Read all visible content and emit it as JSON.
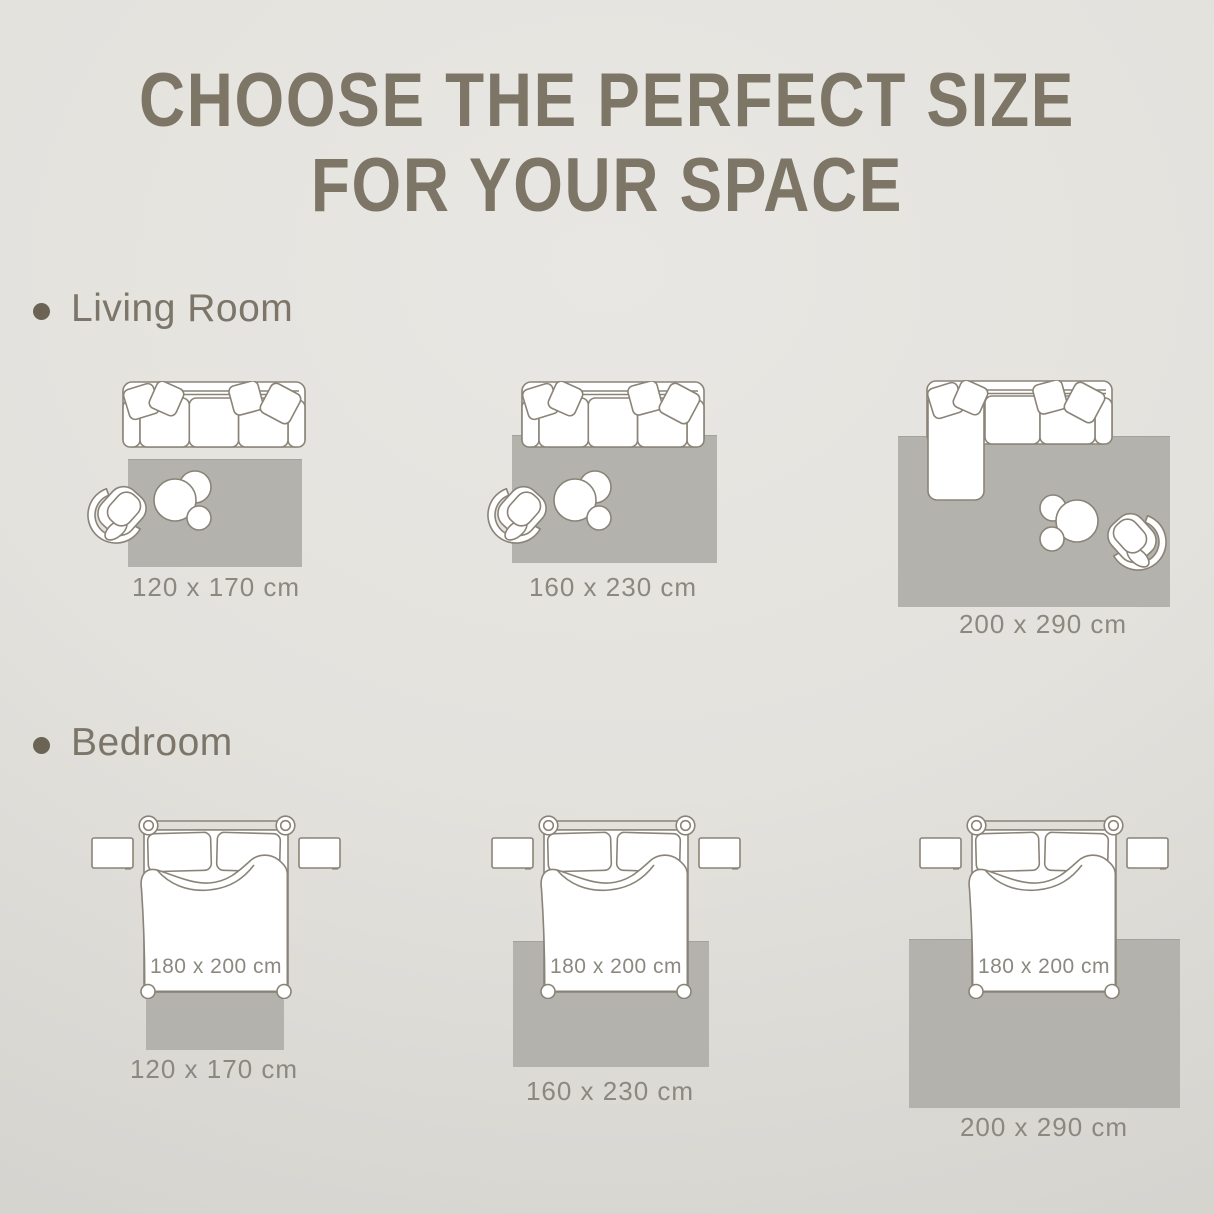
{
  "title": {
    "line1": "CHOOSE THE PERFECT SIZE",
    "line2": "FOR YOUR SPACE"
  },
  "sections": {
    "living_room": {
      "label": "Living Room",
      "items": [
        {
          "rug_size": "120 x 170 cm"
        },
        {
          "rug_size": "160 x 230 cm"
        },
        {
          "rug_size": "200 x 290 cm"
        }
      ]
    },
    "bedroom": {
      "label": "Bedroom",
      "items": [
        {
          "rug_size": "120 x 170 cm",
          "bed_size": "180 x 200 cm"
        },
        {
          "rug_size": "160 x 230 cm",
          "bed_size": "180 x 200 cm"
        },
        {
          "rug_size": "200 x 290 cm",
          "bed_size": "180 x 200 cm"
        }
      ]
    }
  },
  "colors": {
    "title_text": "#7d7566",
    "heading_text": "#7c7569",
    "bullet": "#6b6455",
    "label_text": "#8b887f",
    "rug_fill": "#b3b2ac",
    "line_art_stroke": "#8a8478",
    "background_top": "#e8e6e2",
    "background_bottom": "#d3d1cc"
  }
}
